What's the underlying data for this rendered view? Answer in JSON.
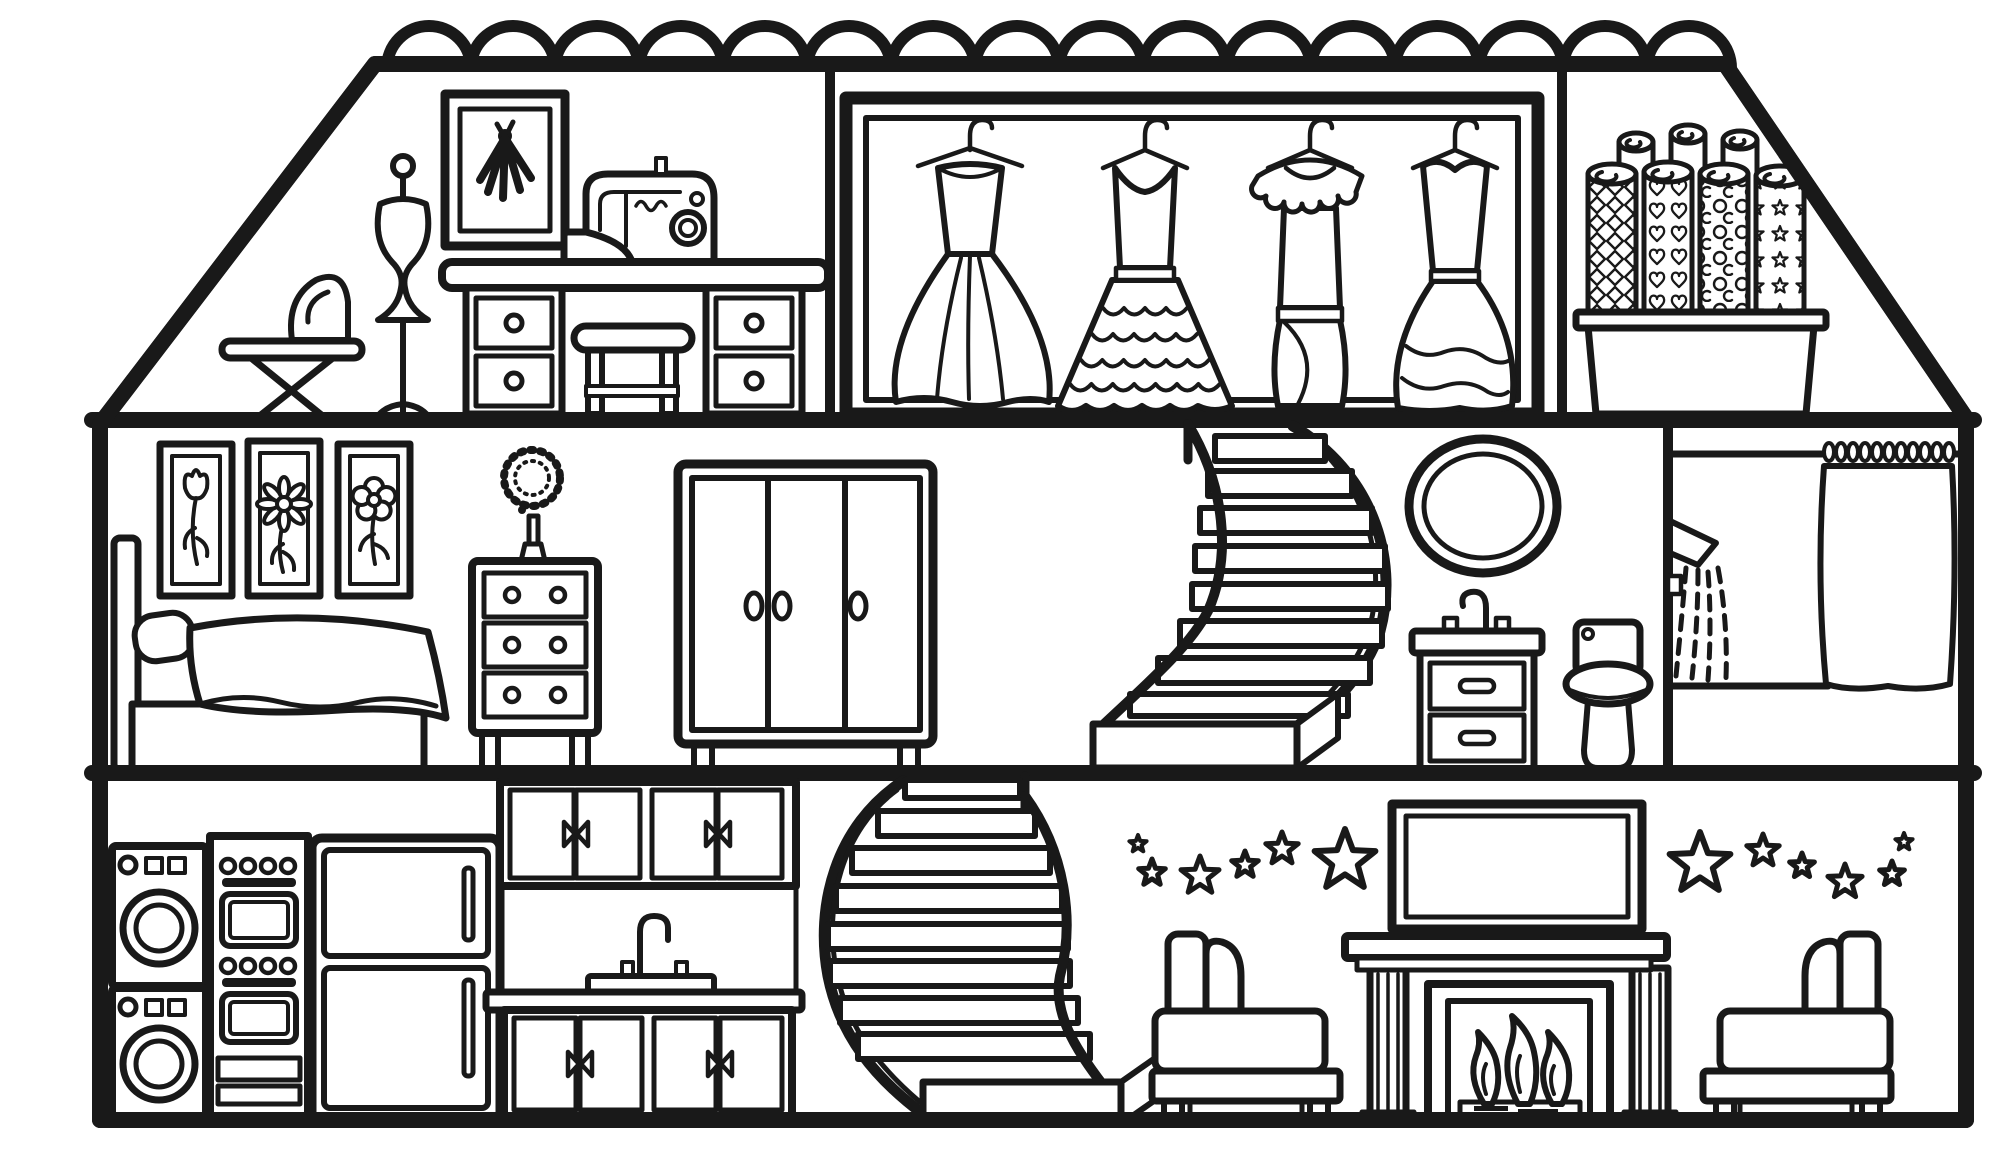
{
  "scene": {
    "title": "Dollhouse cross-section coloring page",
    "style": {
      "ink_color": "#191919",
      "paper_color": "#ffffff"
    },
    "floors": [
      {
        "name": "attic",
        "rooms": [
          {
            "name": "sewing-room",
            "items": [
              "ironing-board",
              "iron",
              "dress-form-mannequin",
              "framed-dress-sketch",
              "sewing-machine",
              "sewing-desk",
              "stool"
            ]
          },
          {
            "name": "dress-closet",
            "dress_count": 4,
            "items": [
              "ball-gown-on-hanger",
              "tiered-ruffle-gown-on-hanger",
              "scallop-collar-dress-on-hanger",
              "sweetheart-ruffle-gown-on-hanger"
            ]
          },
          {
            "name": "fabric-storage",
            "roll_count": 7,
            "patterned_roll_count": 4,
            "plain_roll_count": 3,
            "roll_patterns": [
              "diamonds",
              "hearts",
              "circles",
              "stars"
            ],
            "items": [
              "storage-box",
              "fabric-rolls"
            ]
          }
        ]
      },
      {
        "name": "middle-floor",
        "rooms": [
          {
            "name": "bedroom",
            "wall_art_count": 3,
            "wall_art_flowers": [
              "tulip",
              "daisy",
              "blossom"
            ],
            "items": [
              "bed",
              "headboard",
              "pillow",
              "blanket",
              "dresser-three-drawers",
              "puff-flower-in-vase",
              "wardrobe-three-doors"
            ]
          },
          {
            "name": "stair-landing",
            "items": [
              "curved-staircase-upper"
            ]
          },
          {
            "name": "bathroom",
            "items": [
              "oval-mirror",
              "sink-vanity",
              "faucet",
              "toilet",
              "shower-wall",
              "curtain-rod",
              "curtain-rings",
              "shower-curtain",
              "shower-head",
              "water-spray"
            ]
          }
        ]
      },
      {
        "name": "ground-floor",
        "rooms": [
          {
            "name": "kitchen-laundry",
            "items": [
              "washing-machine",
              "dryer",
              "double-oven",
              "refrigerator",
              "upper-cabinets",
              "hex-tile-backsplash",
              "kitchen-sink",
              "countertop",
              "lower-cabinets"
            ],
            "cabinet_door_count": 8
          },
          {
            "name": "stairwell",
            "items": [
              "curved-staircase-lower"
            ]
          },
          {
            "name": "living-room",
            "star_count_left": 6,
            "star_count_right": 6,
            "flame_count": 3,
            "items": [
              "wall-stars",
              "television",
              "fireplace-mantel",
              "fireplace-columns",
              "firebox",
              "fire",
              "log-grate",
              "armchair-facing-right",
              "armchair-facing-left"
            ]
          }
        ]
      }
    ],
    "structure": {
      "roof_scallop_count": 16,
      "floor_count": 3,
      "outline": "pentagon house with sloped roof sides and scalloped ridge"
    }
  }
}
